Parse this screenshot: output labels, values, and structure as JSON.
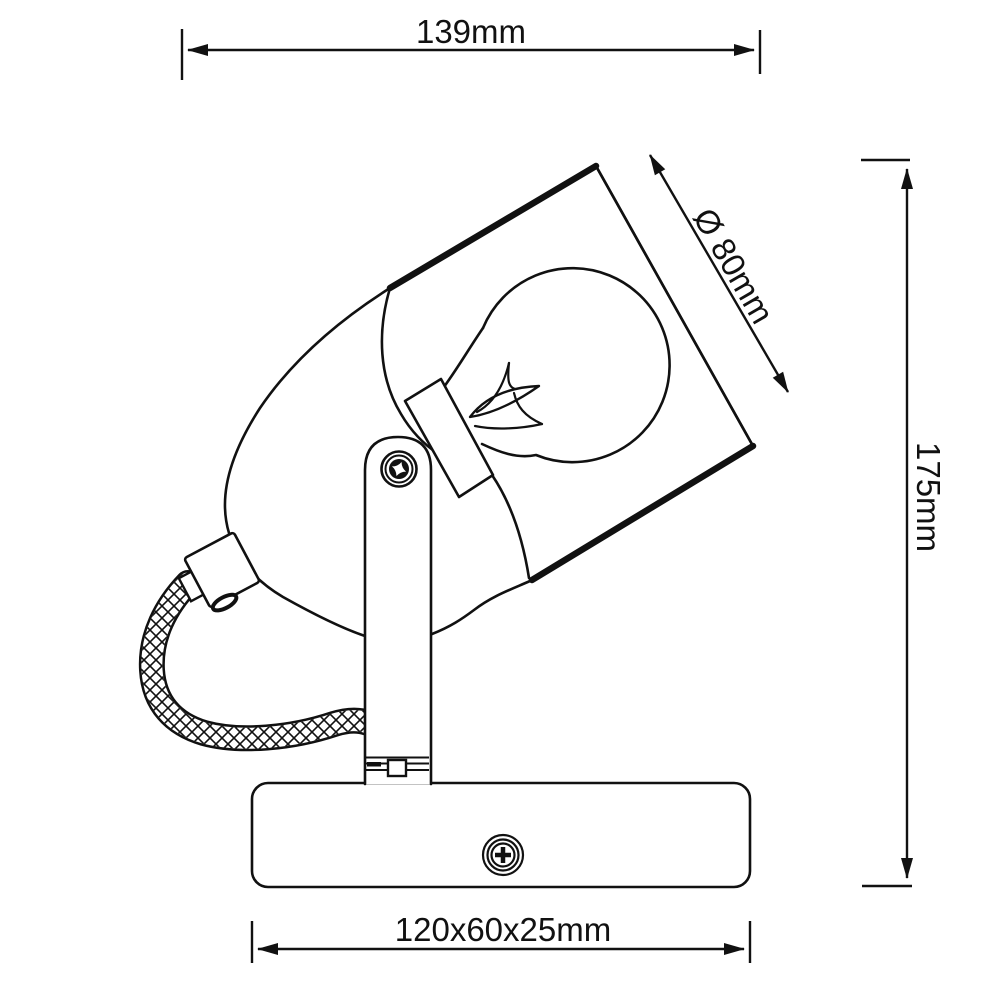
{
  "meta": {
    "title": "Spotlight wall lamp technical dimension drawing"
  },
  "dimensions": {
    "width": {
      "label": "139mm"
    },
    "diameter": {
      "label": "Ø 80mm"
    },
    "height": {
      "label": "175mm"
    },
    "base": {
      "label": "120x60x25mm"
    }
  },
  "colors": {
    "line": "#111111",
    "background": "#ffffff"
  }
}
